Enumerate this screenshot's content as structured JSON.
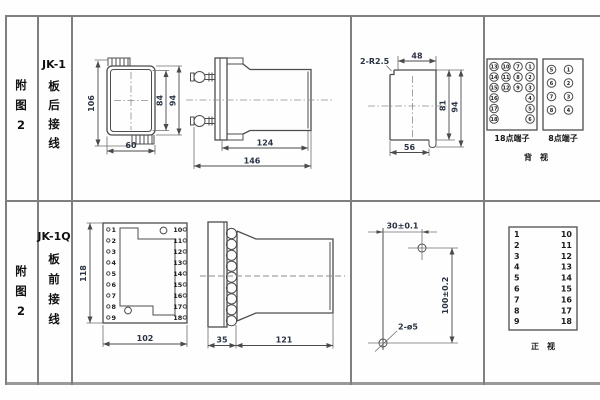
{
  "sheet": {
    "rows": [
      {
        "fig": [
          "附",
          "图",
          "2"
        ],
        "model": "JK-1",
        "wiring": [
          "板",
          "后",
          "接",
          "线"
        ]
      },
      {
        "fig": [
          "附",
          "图",
          "2"
        ],
        "model": "JK-1Q",
        "wiring": [
          "板",
          "前",
          "接",
          "线"
        ]
      }
    ]
  },
  "jk1": {
    "rear": {
      "h": "106",
      "inner_h": "84",
      "outer_h": "94",
      "w": "60"
    },
    "side": {
      "body": "124",
      "total": "146"
    },
    "cutout": {
      "corner": "2-R2.5",
      "top": "48",
      "inner_h": "81",
      "outer_h": "94",
      "bottom": "56"
    },
    "back_view": {
      "t18": [
        [
          "13",
          "10",
          "7",
          "1"
        ],
        [
          "14",
          "11",
          "8",
          "2"
        ],
        [
          "15",
          "12",
          "9",
          "3"
        ],
        [
          "16",
          "4"
        ],
        [
          "17",
          "5"
        ],
        [
          "18",
          "6"
        ]
      ],
      "t8": [
        [
          "5",
          "1"
        ],
        [
          "6",
          "2"
        ],
        [
          "7",
          "3"
        ],
        [
          "8",
          "4"
        ]
      ],
      "t18_label": "18点端子",
      "t8_label": "8点端子",
      "view_label": "背　视"
    }
  },
  "jk1q": {
    "front": {
      "h": "118",
      "w": "102",
      "left": [
        "1",
        "2",
        "3",
        "4",
        "5",
        "6",
        "7",
        "8",
        "9"
      ],
      "right": [
        "10",
        "11",
        "12",
        "13",
        "14",
        "15",
        "16",
        "17",
        "18"
      ]
    },
    "side": {
      "flange": "35",
      "body": "121"
    },
    "drill": {
      "dx": "30±0.1",
      "dy": "100±0.2",
      "holes": "2-ø5"
    },
    "front_table": {
      "left": [
        "1",
        "2",
        "3",
        "4",
        "5",
        "6",
        "7",
        "8",
        "9"
      ],
      "right": [
        "10",
        "11",
        "12",
        "13",
        "14",
        "15",
        "16",
        "17",
        "18"
      ],
      "view_label": "正　视"
    }
  }
}
